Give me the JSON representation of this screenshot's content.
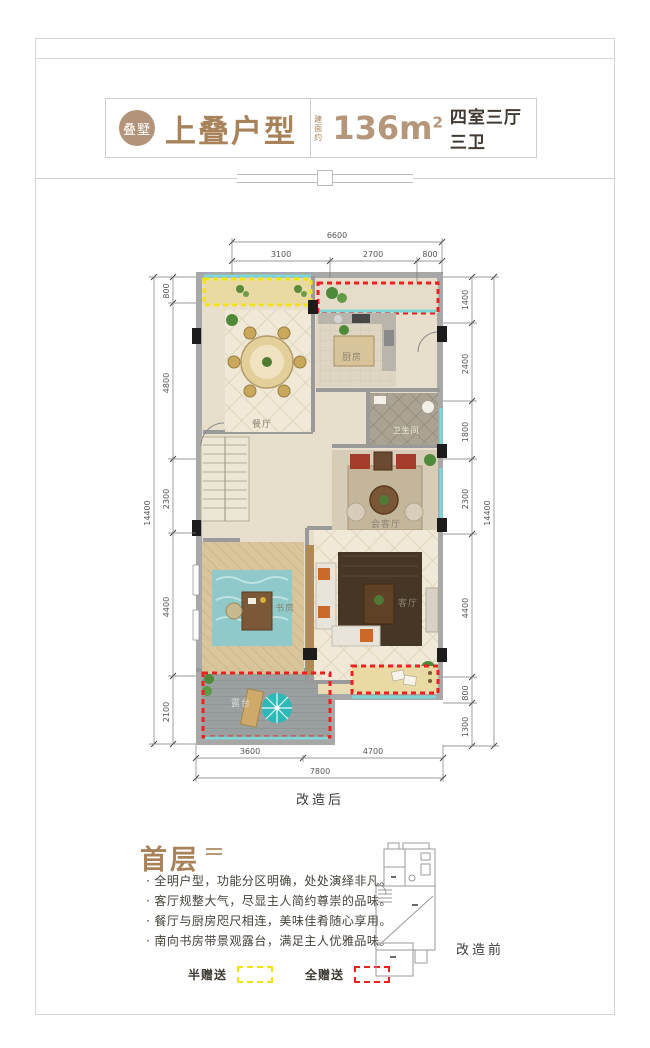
{
  "header": {
    "logo_text": "叠墅",
    "title": "上叠户型",
    "area_prefix": "建面约",
    "area_value": "136m",
    "area_sup": "2",
    "rooms_label": "四室三厅三卫"
  },
  "plan": {
    "caption_after": "改造后",
    "rooms": {
      "dining": "餐厅",
      "kitchen": "厨房",
      "bath": "卫生间",
      "reception": "会客厅",
      "study": "书房",
      "living": "客厅",
      "terrace": "露台"
    },
    "dims": {
      "top": {
        "total": "6600",
        "segments": [
          "3100",
          "2700",
          "800"
        ]
      },
      "left": {
        "total": "14400",
        "segments": [
          "800",
          "4800",
          "2300",
          "4400",
          "2100"
        ]
      },
      "right": {
        "total": "14400",
        "segments": [
          "1400",
          "2400",
          "1800",
          "2300",
          "4400",
          "800",
          "1300"
        ]
      },
      "bottom": {
        "total": "7800",
        "segments": [
          "3600",
          "4700"
        ]
      }
    }
  },
  "footer": {
    "section_title": "首层",
    "bullets": [
      "全明户型，功能分区明确，处处演绎非凡。",
      "客厅规整大气，尽显主人简约尊崇的品味。",
      "餐厅与厨房咫尺相连，美味佳肴随心享用。",
      "南向书房带景观露台，满足主人优雅品味。"
    ],
    "legend": {
      "half": "半赠送",
      "full": "全赠送"
    },
    "caption_before": "改造前"
  },
  "colors": {
    "accent_brown": "#a8835a",
    "highlight_yellow": "#f2e20e",
    "highlight_red": "#ee2020",
    "window_teal": "#7fd6d6"
  }
}
